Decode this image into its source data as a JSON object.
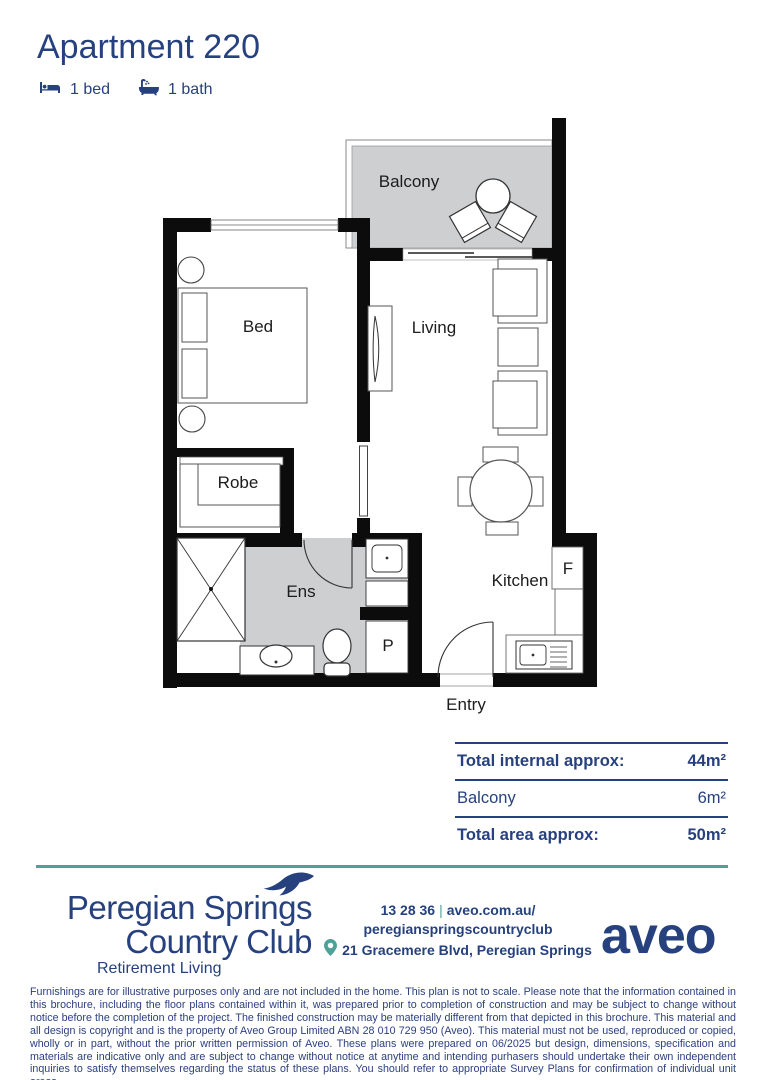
{
  "header": {
    "title": "Apartment 220",
    "bedrooms": "1 bed",
    "bathrooms": "1 bath"
  },
  "floorplan": {
    "labels": {
      "balcony": "Balcony",
      "bed": "Bed",
      "living": "Living",
      "robe": "Robe",
      "ens": "Ens",
      "kitchen": "Kitchen",
      "fridge": "F",
      "pantry": "P",
      "entry": "Entry"
    }
  },
  "areas": {
    "rows": [
      {
        "label": "Total internal approx:",
        "value": "44m²"
      },
      {
        "label": "Balcony",
        "value": "6m²"
      },
      {
        "label": "Total area approx:",
        "value": "50m²"
      }
    ]
  },
  "footer": {
    "brand": {
      "line1": "Peregian Springs",
      "line2": "Country Club",
      "tagline": "Retirement Living"
    },
    "contact": {
      "phone": "13 28 36",
      "separator": "|",
      "website_line1": "aveo.com.au/",
      "website_line2": "peregianspringscountryclub",
      "address": "21 Gracemere Blvd, Peregian Springs"
    },
    "aveo_logo": "aveo"
  },
  "disclaimer": "Furnishings are for illustrative purposes only and are not included in the home. This plan is not to scale. Please note that the information contained in this brochure, including the floor plans contained within it, was prepared prior to completion of construction and may be subject to change without notice before the completion of the project. The finished construction may be materially different from that depicted in this brochure. This material and all design is copyright and is the property of Aveo Group Limited ABN 28 010 729 950 (Aveo). This material must not be used, reproduced or copied, wholly or in part, without the prior written permission of Aveo. These plans were prepared on 06/2025 but design, dimensions, specification and materials are indicative only and are subject to change without notice at anytime and intending purhasers should undertake their own independent inquiries to satisfy themselves regarding the status of these plans. You should refer to appropriate Survey Plans for confirmation of individual unit areas.",
  "colors": {
    "navy": "#26417e",
    "teal": "#4fa096",
    "plan_gray": "#cdcfd1",
    "wall_black": "#0c0c0c"
  }
}
